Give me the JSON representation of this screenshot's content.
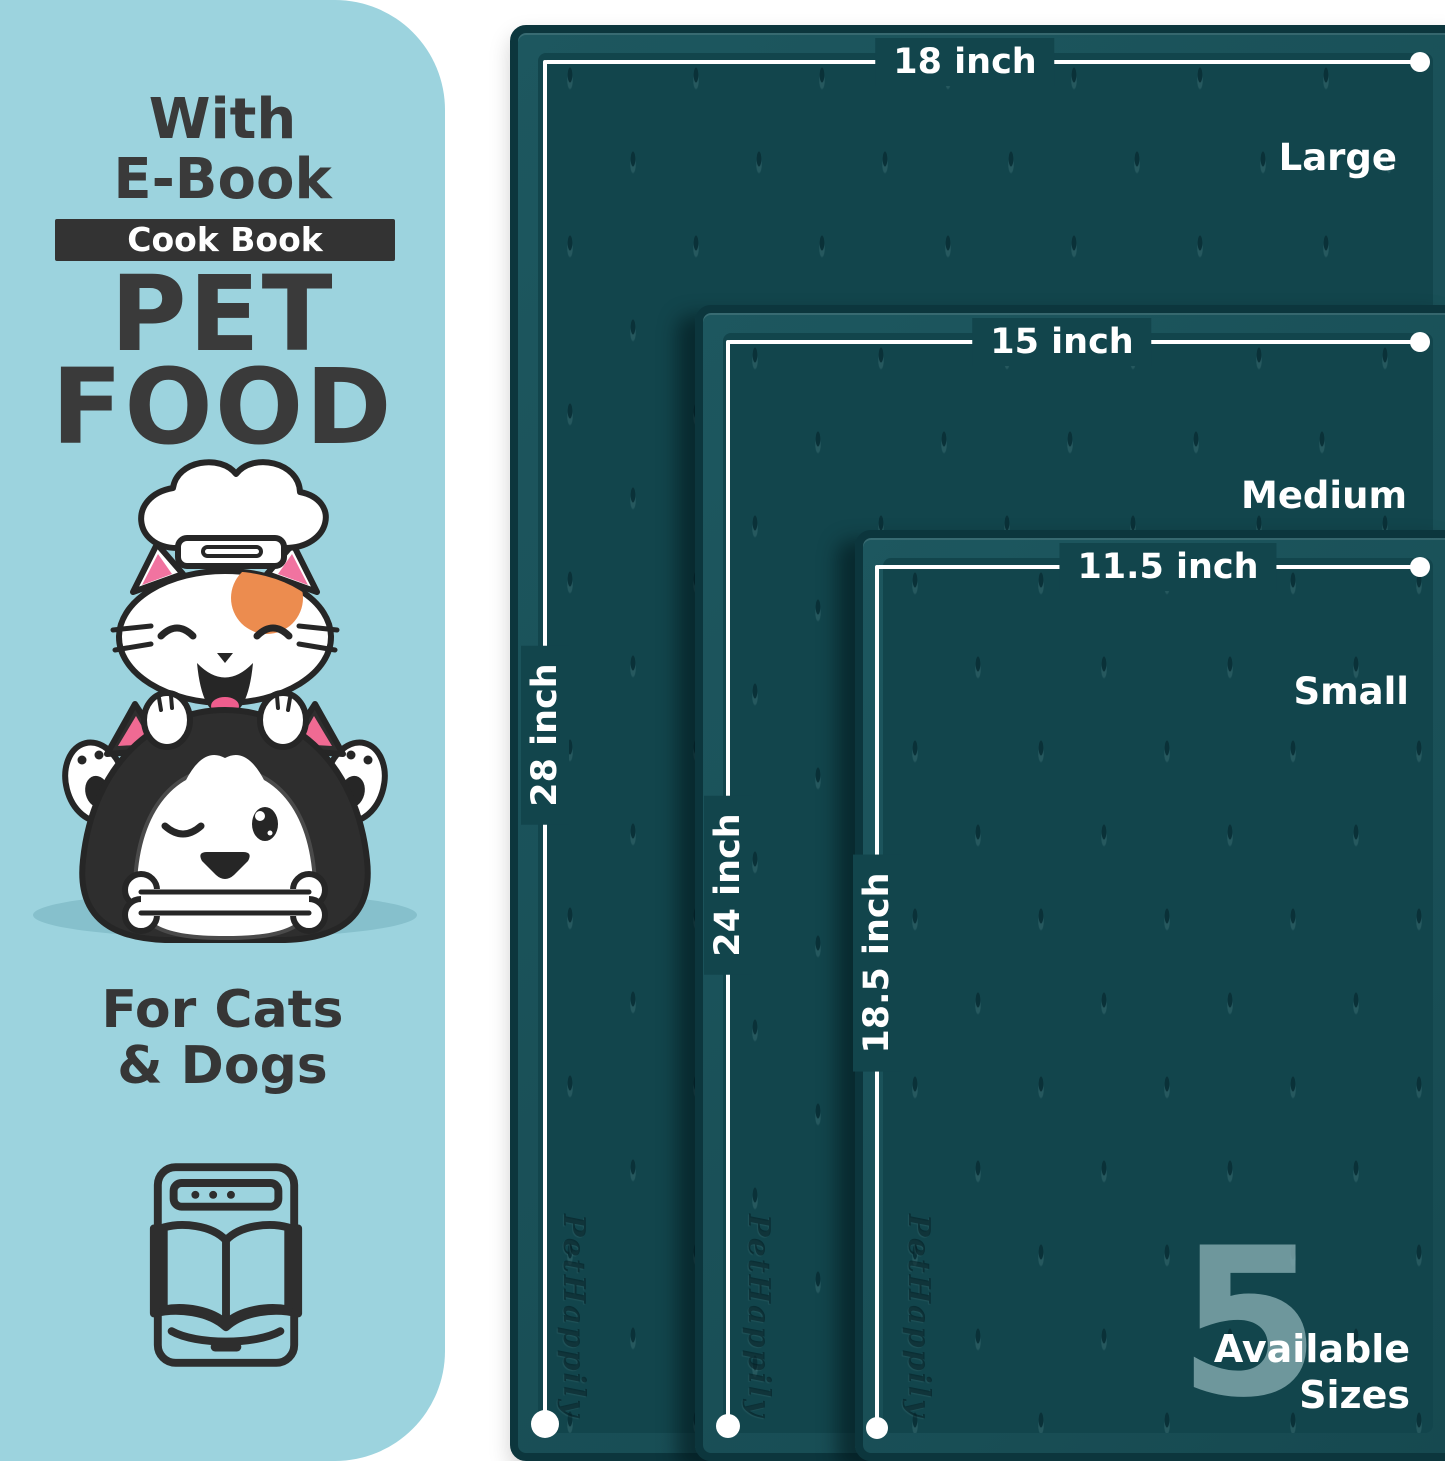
{
  "panel": {
    "bg_color": "#9cd3de",
    "with_line1": "With",
    "with_line2": "E-Book",
    "cookbook_badge": "Cook Book",
    "title_line1": "PET",
    "title_line2": "FOOD",
    "audience_line1": "For Cats",
    "audience_line2": "& Dogs"
  },
  "mats": [
    {
      "size_name": "Large",
      "width_label": "18 inch",
      "height_label": "28 inch"
    },
    {
      "size_name": "Medium",
      "width_label": "15 inch",
      "height_label": "24 inch"
    },
    {
      "size_name": "Small",
      "width_label": "11.5 inch",
      "height_label": "18.5 inch"
    }
  ],
  "sizes_badge": {
    "number": "5",
    "line1": "Available",
    "line2": "Sizes"
  },
  "emboss_text": "PetHappily",
  "colors": {
    "mat_surface": "#12454c",
    "mat_border": "#0c363d",
    "mat_bevel": "#1d575f",
    "panel_bg": "#9cd3de",
    "text_dark": "#3a3a3a",
    "watermark": "#7fa6ab",
    "accent_orange": "#ec8c4f",
    "accent_pink": "#ef5d8d"
  }
}
